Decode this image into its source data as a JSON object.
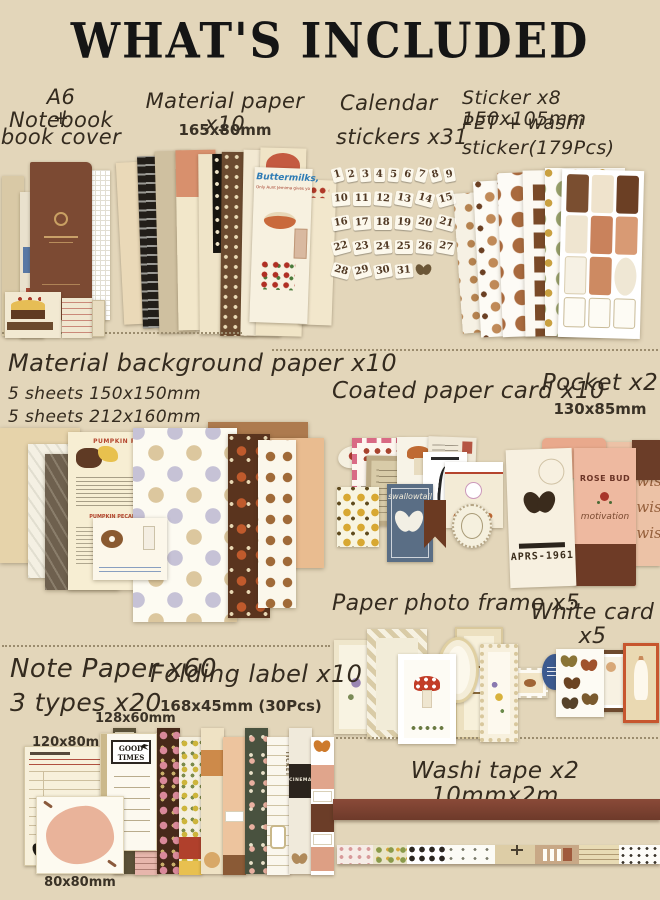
{
  "title": "WHAT'S INCLUDED",
  "colors": {
    "background": "#e3d6ba",
    "notebook_brown": "#7c4a33",
    "ink": "#332a1e",
    "washi_brown": "#7a4232"
  },
  "sections": {
    "notebook": {
      "label_lines": [
        "A6 Notebook",
        "+",
        "book cover"
      ]
    },
    "material_paper": {
      "label": "Material paper x10",
      "size": "165x80mm",
      "decor": {
        "heading": "Buttermilks,",
        "subheading": "Only Aunt Jemima gives you"
      }
    },
    "calendar_stickers": {
      "label_lines": [
        "Calendar",
        "stickers x31"
      ],
      "numbers": [
        "1",
        "2",
        "3",
        "4",
        "5",
        "6",
        "7",
        "8",
        "9",
        "10",
        "11",
        "12",
        "13",
        "14",
        "15",
        "16",
        "17",
        "18",
        "19",
        "20",
        "21",
        "22",
        "23",
        "24",
        "25",
        "26",
        "27",
        "28",
        "29",
        "30",
        "31"
      ]
    },
    "sticker_sheets": {
      "label_lines": [
        "Sticker x8 150x105mm",
        "PET + washi",
        "sticker(179Pcs)"
      ]
    },
    "background_paper": {
      "label": "Material background paper x10",
      "sizes": [
        "5 sheets 150x150mm",
        "5 sheets 212x160mm"
      ],
      "decor": {
        "recipe_title": "PUMPKIN PIE",
        "recipe_title2": "PUMPKIN PECAN PIE"
      }
    },
    "coated_card": {
      "label": "Coated paper card x10",
      "decor": {
        "blue_card_script": "swallowtail"
      }
    },
    "pocket": {
      "label": "Pocket x2",
      "size": "130x85mm",
      "decor": {
        "date_code": "APRS-1961",
        "card_title": "ROSE BUD",
        "card_script": "motivation",
        "sheet_script": "Best wishes"
      }
    },
    "photo_frame": {
      "label": "Paper photo frame x5"
    },
    "white_card": {
      "label": "White card x5"
    },
    "note_paper": {
      "label_lines": [
        "Note Paper x60",
        "3 types x20"
      ],
      "sizes": [
        "120x80mm",
        "128x60mm",
        "80x80mm"
      ],
      "decor": {
        "pad_title": "GOOD TIMES"
      }
    },
    "folding_label": {
      "label": "Folding label x10",
      "size": "168x45mm (30Pcs)",
      "decor": {
        "strip_text1": "TICKET",
        "strip_text2": "CINEMA"
      }
    },
    "washi_tape": {
      "label": "Washi tape x2 10mmx2m"
    }
  }
}
